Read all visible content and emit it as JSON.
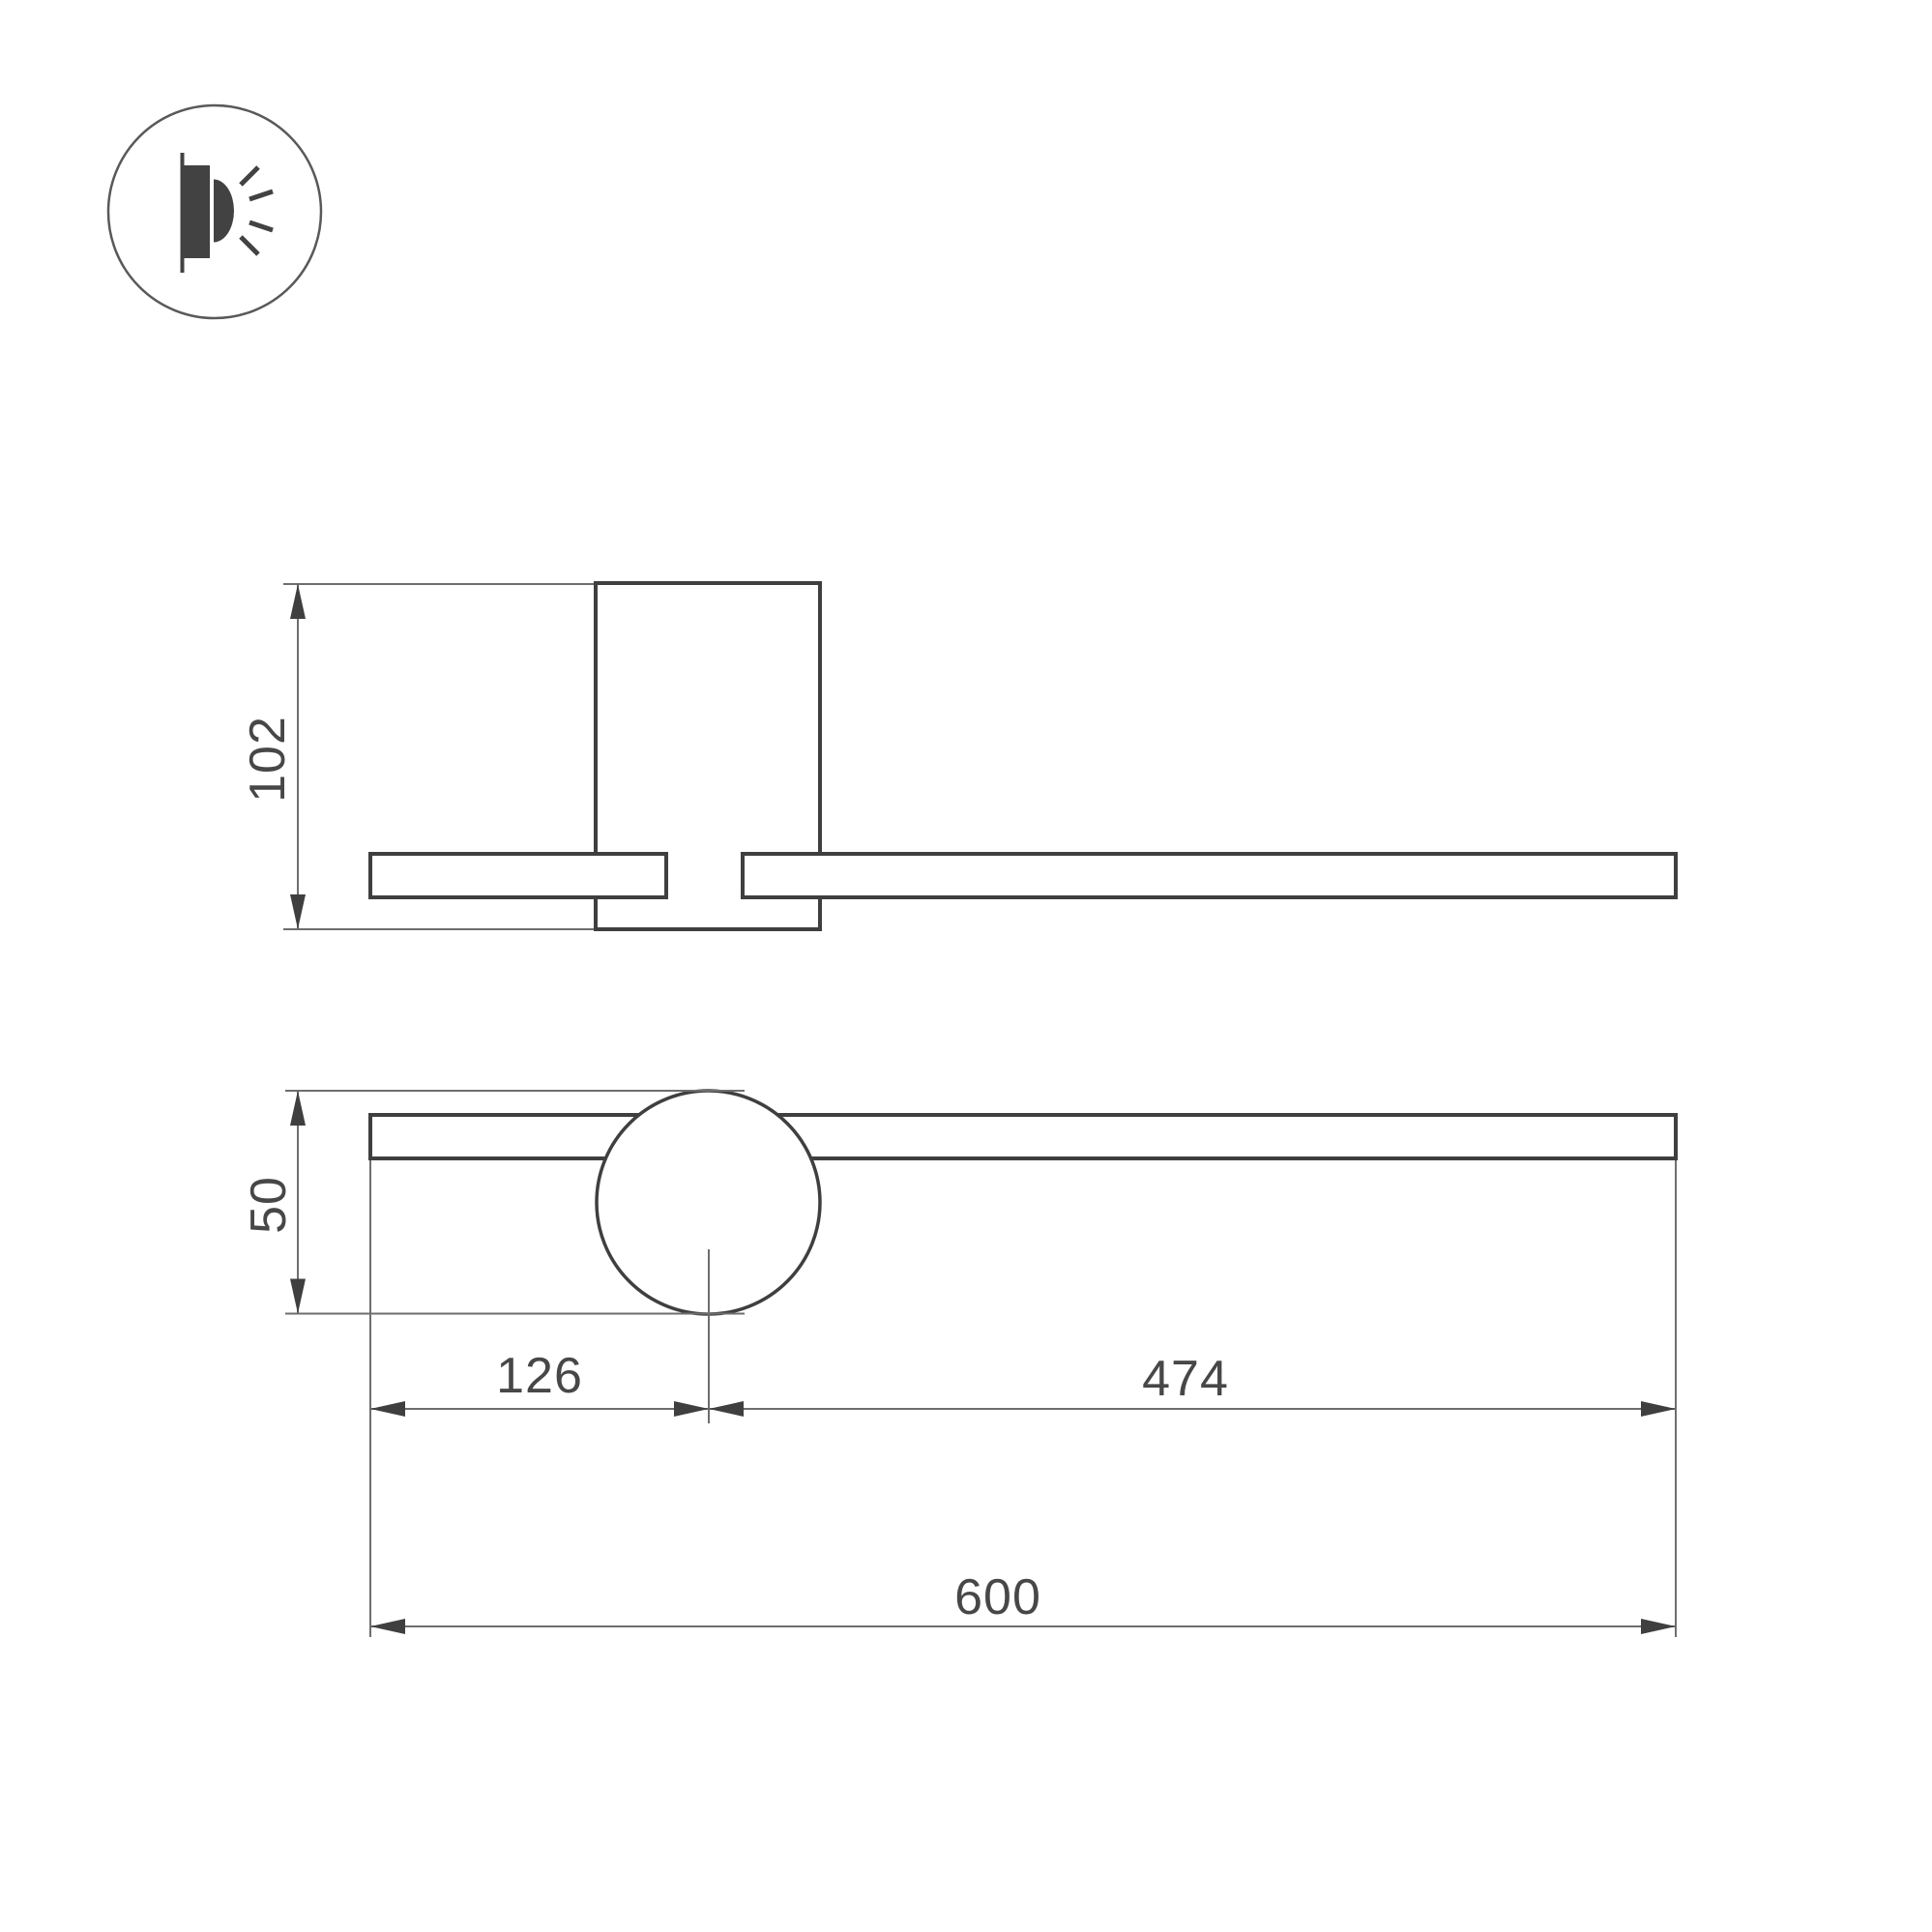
{
  "icon": {
    "name": "wall-light-icon"
  },
  "dimensions": {
    "side_height": "102",
    "front_height": "50",
    "offset_left": "126",
    "offset_right": "474",
    "total_width": "600"
  },
  "colors": {
    "outline_bold": "#3f3f3f",
    "line_thin": "#6e6e6e",
    "text": "#474747",
    "icon": "#424242",
    "background": "#ffffff"
  }
}
